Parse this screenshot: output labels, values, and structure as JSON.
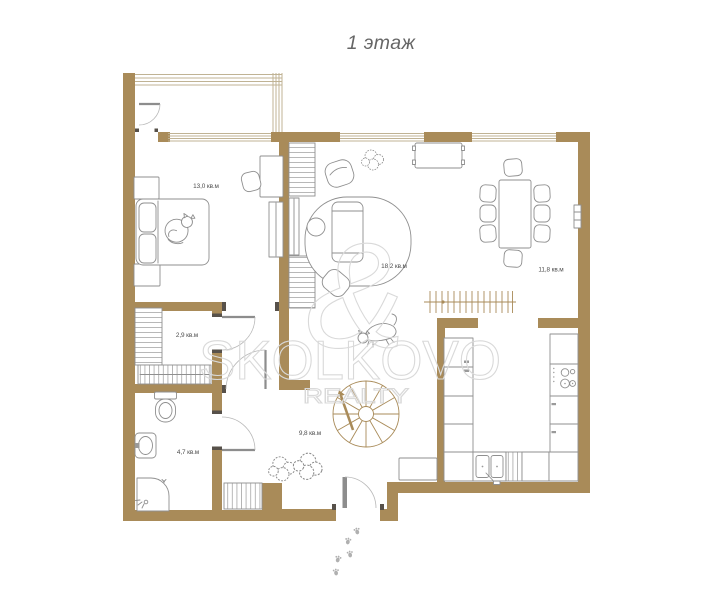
{
  "title": "1 этаж",
  "watermark": {
    "brand": "SKOLKOVO",
    "sub": "REALTY",
    "monogram": "&"
  },
  "rooms": {
    "bedroom": {
      "area": "13,0 кв.м"
    },
    "closet": {
      "area": "2,9 кв.м"
    },
    "bathroom": {
      "area": "4,7 кв.м"
    },
    "hallway": {
      "area": "9,8 кв.м"
    },
    "living": {
      "area": "18,2 кв.м"
    },
    "dining": {
      "area": "11,8 кв.м"
    }
  },
  "colors": {
    "wall": "#a98b59",
    "furniture": "#8f8f8f",
    "window": "#c0b394",
    "label": "#4d4d4d",
    "watermark": "#d9d9d9",
    "paw": "#b0b0b0",
    "title": "#666666"
  }
}
